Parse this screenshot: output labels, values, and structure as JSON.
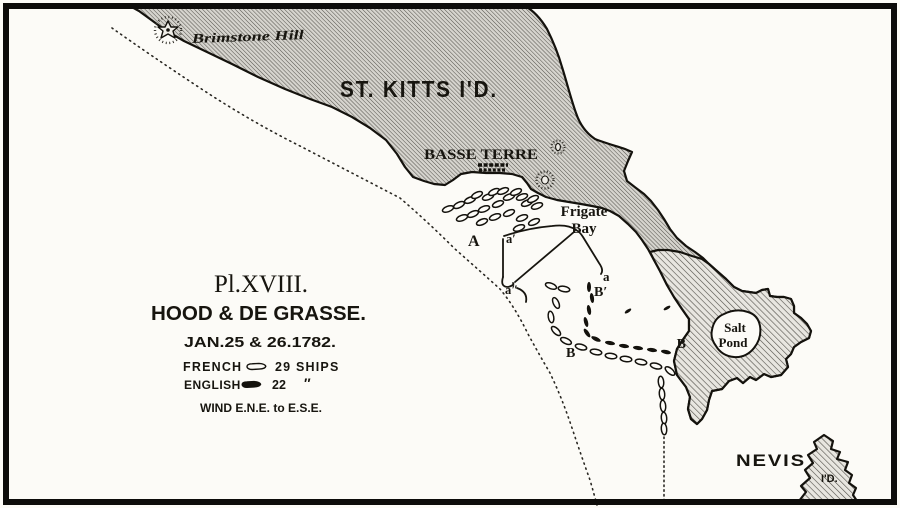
{
  "plate": {
    "number": "Pl.XVIII.",
    "title": "HOOD & DE GRASSE.",
    "date": "JAN.25 & 26.1782.",
    "french_label": "FRENCH",
    "french_count": "29 SHIPS",
    "english_label": "ENGLISH",
    "english_count": "22",
    "english_ditto": "″",
    "wind": "WIND E.N.E. to E.S.E."
  },
  "map_labels": {
    "island": "ST. KITTS I'D.",
    "brimstone_hill": "Brimstone Hill",
    "basse_terre": "BASSE TERRE",
    "frigate_line1": "Frigate",
    "frigate_line2": "Bay",
    "salt_line1": "Salt",
    "salt_line2": "Pond",
    "nevis": "NEVIS",
    "nevis_id": "I'D.",
    "pos_A": "A",
    "pos_a_prime": "a′",
    "pos_a_doubleprime": "a″",
    "pos_a": "a",
    "pos_B_prime": "B′",
    "pos_B_left": "B",
    "pos_B_right": "B"
  },
  "colors": {
    "paper": "#fcfbf7",
    "ink": "#17150f",
    "land_dense": "#d6d4ce",
    "land_light": "#e8e6e0"
  },
  "fleets": {
    "french_anchored": [
      [
        448,
        209,
        -20
      ],
      [
        459,
        205,
        -25
      ],
      [
        470,
        200,
        -22
      ],
      [
        477,
        195,
        -25
      ],
      [
        488,
        197,
        -20
      ],
      [
        494,
        192,
        -25
      ],
      [
        503,
        191,
        -22
      ],
      [
        509,
        197,
        -20
      ],
      [
        516,
        192,
        -24
      ],
      [
        522,
        197,
        -20
      ],
      [
        527,
        203,
        -22
      ],
      [
        533,
        199,
        -25
      ],
      [
        537,
        206,
        -20
      ],
      [
        498,
        204,
        -22
      ],
      [
        484,
        209,
        -20
      ],
      [
        473,
        214,
        -24
      ],
      [
        462,
        218,
        -20
      ],
      [
        482,
        222,
        -22
      ],
      [
        495,
        217,
        -20
      ],
      [
        509,
        213,
        -23
      ],
      [
        522,
        218,
        -20
      ],
      [
        534,
        222,
        -24
      ],
      [
        519,
        228,
        -20
      ]
    ],
    "french_track": [
      [
        551,
        286,
        20
      ],
      [
        564,
        289,
        10
      ],
      [
        556,
        303,
        65
      ],
      [
        551,
        317,
        80
      ],
      [
        556,
        331,
        45
      ],
      [
        566,
        341,
        25
      ],
      [
        581,
        347,
        15
      ],
      [
        596,
        352,
        10
      ],
      [
        611,
        356,
        8
      ],
      [
        626,
        359,
        8
      ],
      [
        641,
        362,
        10
      ],
      [
        656,
        366,
        15
      ],
      [
        670,
        371,
        40
      ],
      [
        661,
        382,
        85
      ],
      [
        662,
        394,
        85
      ],
      [
        663,
        406,
        85
      ],
      [
        664,
        418,
        85
      ],
      [
        664,
        429,
        85
      ]
    ],
    "english_line": [
      [
        589,
        287,
        90
      ],
      [
        592,
        298,
        82
      ],
      [
        589,
        310,
        80
      ],
      [
        586,
        322,
        75
      ],
      [
        587,
        333,
        55
      ],
      [
        596,
        339,
        25
      ],
      [
        610,
        343,
        10
      ],
      [
        624,
        346,
        8
      ],
      [
        638,
        348,
        8
      ],
      [
        652,
        350,
        8
      ],
      [
        666,
        352,
        12
      ]
    ],
    "english_scouts": [
      [
        628,
        311,
        -35,
        0.75
      ],
      [
        667,
        308,
        -30,
        0.75
      ]
    ]
  }
}
